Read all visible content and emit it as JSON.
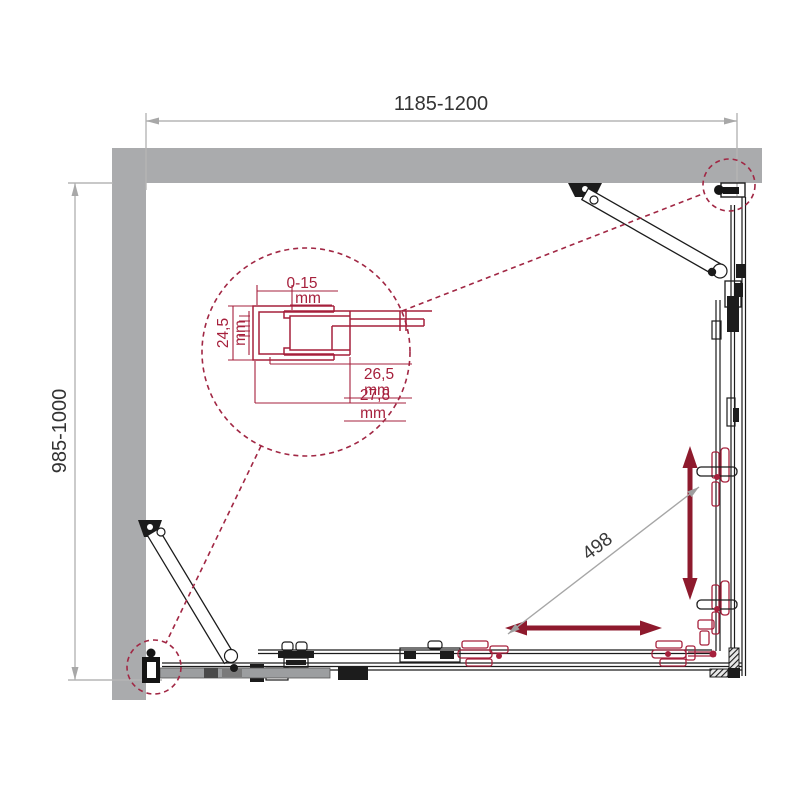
{
  "drawing": {
    "type": "shower-enclosure-plan-technical-drawing",
    "labels": {
      "width_range": "1185-1200",
      "depth_range": "985-1000",
      "door_travel": "498"
    },
    "detail": {
      "gap": "0-15",
      "gap_unit": "mm",
      "profile_depth": "24,5",
      "profile_depth_unit": "mm",
      "inner_width": "26,5",
      "inner_width_unit": "mm",
      "outer_width": "27,8",
      "outer_width_unit": "mm"
    },
    "colors": {
      "wall_gray": "#aaabad",
      "dimension_gray": "#b5b5b5",
      "line_black": "#1c1c1c",
      "arrow_crimson": "#8e1a2d",
      "detail_crimson": "#a6203c",
      "callout_dash_crimson": "#a12744"
    }
  }
}
